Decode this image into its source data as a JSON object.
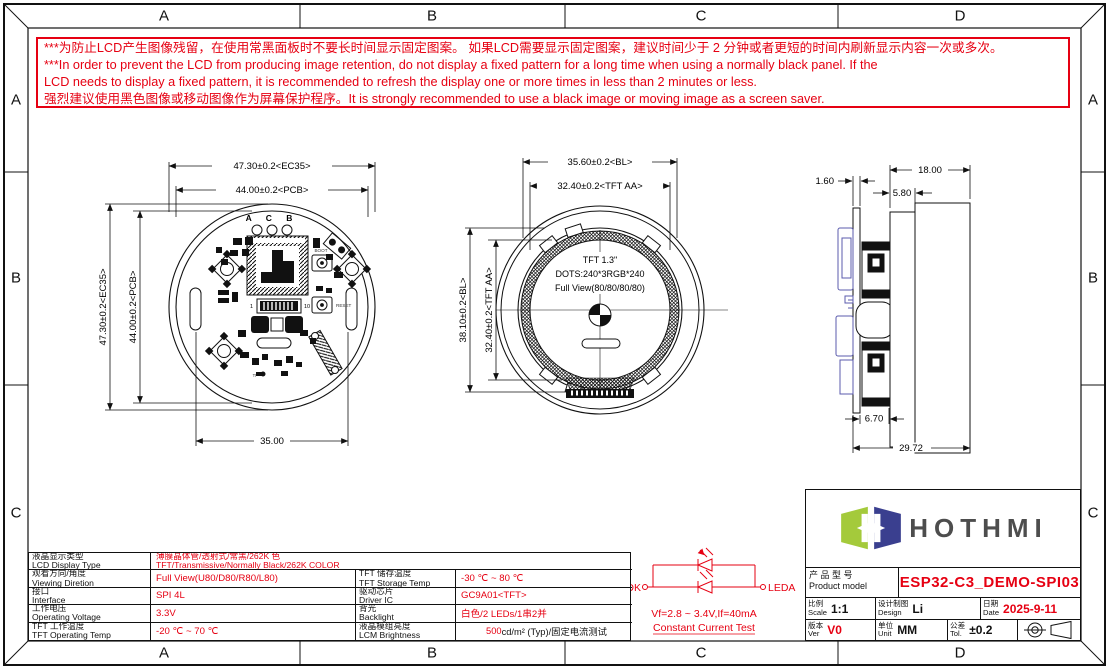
{
  "colors": {
    "accent_red": "#e60012",
    "line_black": "#111111",
    "side_component_blue": "#5b5bad",
    "logo_green": "#a4ca3b",
    "logo_navy": "#3a3f8f",
    "logo_gray": "#4d4d4d"
  },
  "frame": {
    "cols": [
      "A",
      "B",
      "C",
      "D"
    ],
    "rows": [
      "A",
      "B",
      "C"
    ]
  },
  "warning": {
    "line1": "***为防止LCD产生图像残留，在使用常黑面板时不要长时间显示固定图案。 如果LCD需要显示固定图案，建议时间少于 2 分钟或者更短的时间内刷新显示内容一次或多次。",
    "line2": "***In order to prevent the LCD from producing image retention, do not display a fixed pattern for a long time when using a normally black panel. If the",
    "line3": " LCD needs to display a fixed pattern, it is recommended to refresh the display one or more times in less than 2 minutes or less.",
    "line4": "强烈建议使用黑色图像或移动图像作为屏幕保护程序。It is strongly recommended to use a black image or moving image as a screen saver."
  },
  "front_view": {
    "dim_top_outer": "47.30±0.2<EC35>",
    "dim_top_inner": "44.00±0.2<PCB>",
    "dim_left_outer": "47.30±0.2<EC35>",
    "dim_left_inner": "44.00±0.2<PCB>",
    "dim_bottom": "35.00",
    "hole_labels": "A C B",
    "pin_first": "1",
    "pin_last": "10",
    "boot_label": "BOOT",
    "reset_label": "RESET",
    "tp_label": "TP"
  },
  "lcd_view": {
    "dim_top_outer": "35.60±0.2<BL>",
    "dim_top_inner": "32.40±0.2<TFT AA>",
    "dim_left_outer": "38.10±0.2<BL>",
    "dim_left_inner": "32.40±0.2<TFT AA>",
    "line1": "TFT 1.3\"",
    "line2": "DOTS:240*3RGB*240",
    "line3": "Full View(80/80/80/80)"
  },
  "side_view": {
    "dim_pcb_thickness": "1.60",
    "dim_module_depth": "18.00",
    "dim_flange": "5.80",
    "dim_gap": "6.70",
    "dim_total": "29.72"
  },
  "circuit": {
    "left_label": "LEDK",
    "right_label": "LEDA",
    "spec": "Vf=2.8 ~ 3.4V,If=40mA",
    "test": "Constant Current Test"
  },
  "spec_table": {
    "rows": [
      {
        "label_cn": "液晶显示类型",
        "label_en": "LCD Display Type",
        "value_cn": "薄膜晶体管/透射式/常黑/262K 色",
        "value_en": "TFT/Transmissive/Normally Black/262K COLOR"
      },
      {
        "label_cn": "观看方向/角度",
        "label_en": "Viewing Diretion",
        "value": "Full View(U80/D80/R80/L80)",
        "label2_cn": "TFT 储存温度",
        "label2_en": "TFT Storage Temp",
        "value2": "-30 ℃ ~ 80 ℃"
      },
      {
        "label_cn": "接口",
        "label_en": "Interface",
        "value": "SPI 4L",
        "label2_cn": "驱动芯片",
        "label2_en": "Driver IC",
        "value2": "GC9A01<TFT>"
      },
      {
        "label_cn": "工作电压",
        "label_en": "Operating Voltage",
        "value": "3.3V",
        "label2_cn": "背光",
        "label2_en": "Backlight",
        "value2": "白色/2 LEDs/1串2并"
      },
      {
        "label_cn": "TFT 工作温度",
        "label_en": "TFT Operating Temp",
        "value": "-20 ℃ ~ 70 ℃",
        "label2_cn": "液晶模组亮度",
        "label2_en": "LCM Brightness",
        "value2_red": "500",
        "value2_black": " cd/m² (Typ)/固定电流测试"
      }
    ]
  },
  "title_block": {
    "logo_text": "HOTHMI",
    "product_label_cn": "产 品 型 号",
    "product_label_en": "Product model",
    "product_model": "ESP32-C3_DEMO-SPI03",
    "scale_cn": "比例",
    "scale_en": "Scale",
    "scale_value": "1:1",
    "design_cn": "设计制图",
    "design_en": "Design",
    "design_value": "Li",
    "date_cn": "日期",
    "date_en": "Date",
    "date_value": "2025-9-11",
    "ver_cn": "版本",
    "ver_en": "Ver",
    "ver_value": "V0",
    "unit_cn": "单位",
    "unit_en": "Unit",
    "unit_value": "MM",
    "tol_cn": "公差",
    "tol_en": "Tol.",
    "tol_value": "±0.2"
  }
}
